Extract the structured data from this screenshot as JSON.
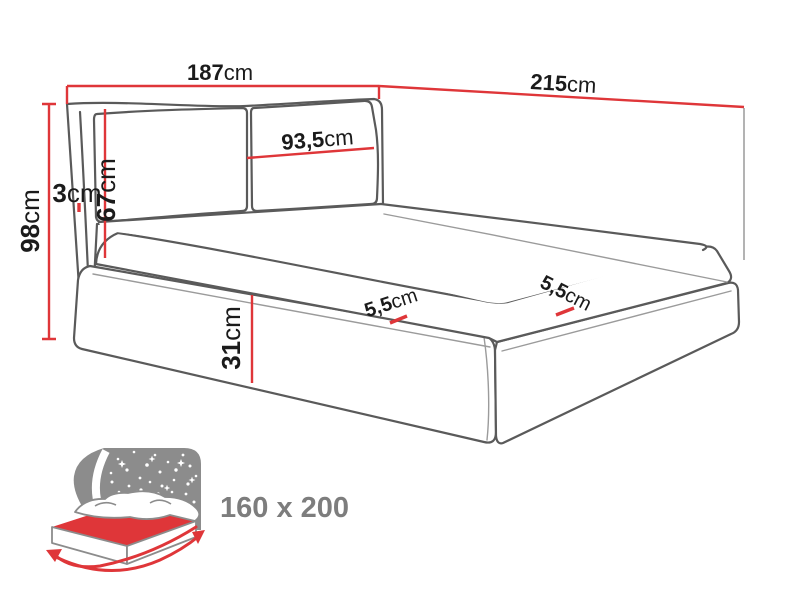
{
  "diagram_title": "upholstered-bed-dimension-diagram",
  "dims": {
    "total_width": {
      "value": "187",
      "unit": "cm"
    },
    "total_length": {
      "value": "215",
      "unit": "cm"
    },
    "total_height": {
      "value": "98",
      "unit": "cm"
    },
    "wing_depth": {
      "value": "3",
      "unit": "cm"
    },
    "headboard_height": {
      "value": "67",
      "unit": "cm"
    },
    "cushion_width": {
      "value": "93,5",
      "unit": "cm"
    },
    "base_height": {
      "value": "31",
      "unit": "cm"
    },
    "mattress_edge_side": {
      "value": "5,5",
      "unit": "cm"
    },
    "mattress_edge_foot": {
      "value": "5,5",
      "unit": "cm"
    }
  },
  "icon": {
    "size_label": "160 x 200"
  },
  "colors": {
    "dimension_red": "#df3639",
    "outline_gray": "#5a5a5a",
    "icon_gray": "#8c8c8c"
  }
}
